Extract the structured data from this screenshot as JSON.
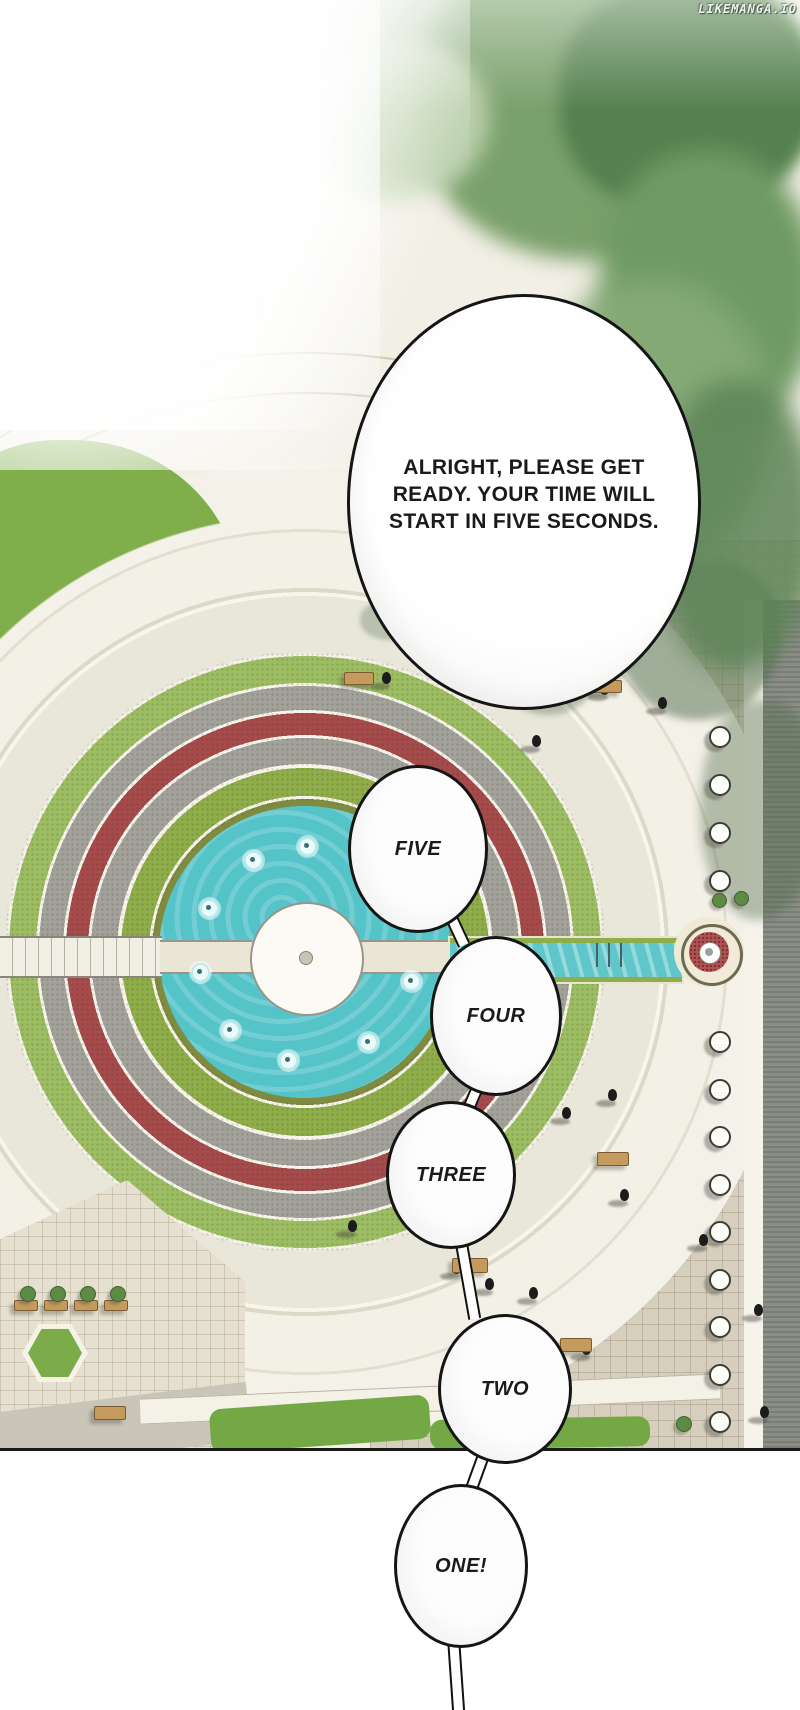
{
  "watermark": {
    "text": "LIKEMANGA.IO"
  },
  "speech": {
    "announcement": {
      "line1": "ALRIGHT, PLEASE GET",
      "line2": "READY. YOUR TIME WILL",
      "line3": "START IN FIVE SECONDS."
    },
    "countdown": {
      "five": "FIVE",
      "four": "FOUR",
      "three": "THREE",
      "two": "TWO",
      "one": "ONE!"
    }
  },
  "scene": {
    "palette": {
      "pond_water": "#54c4c9",
      "grass": "#7fae4a",
      "ring_green": "#8fae49",
      "flower_red": "#a64b4b",
      "gravel_gray": "#a3a29a",
      "plaza_tile": "#d7cfbd",
      "path_light": "#f2efe5",
      "foliage_dark": "#55814f",
      "foliage_light": "#9db98a",
      "bench_wood": "#c49a5d",
      "ink": "#151515"
    }
  }
}
